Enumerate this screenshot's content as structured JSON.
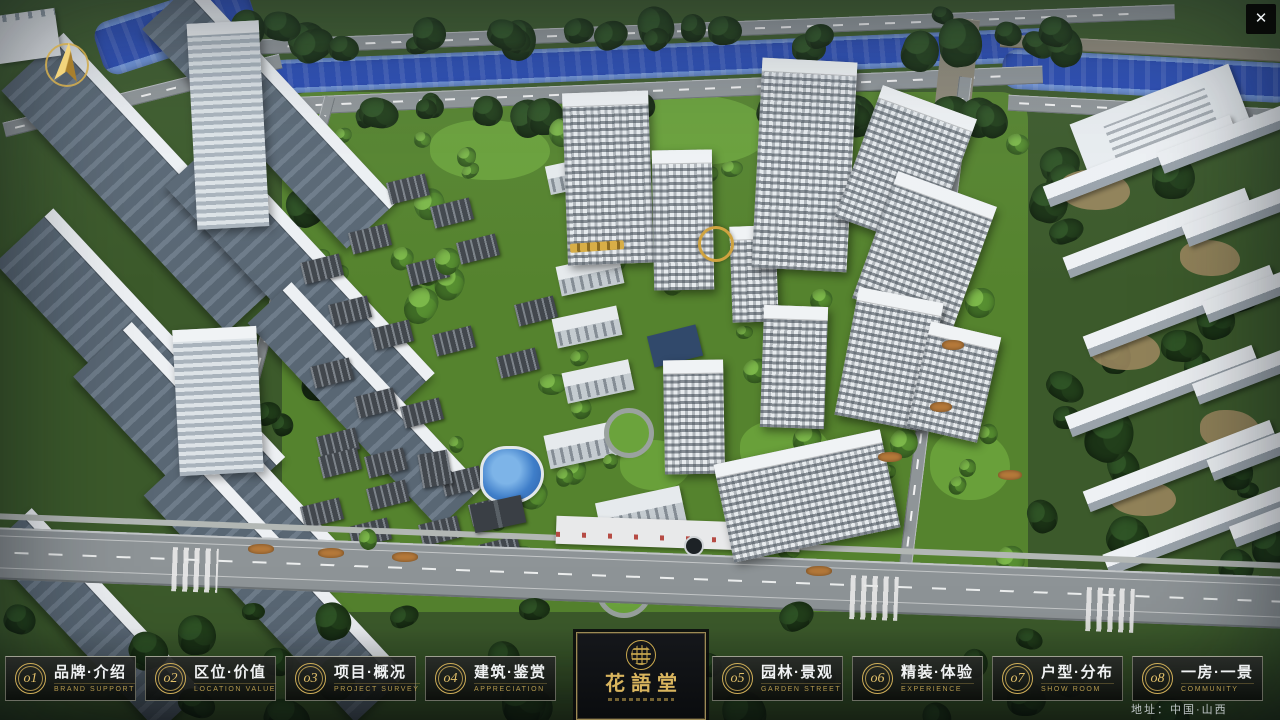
{
  "nav": {
    "items": [
      {
        "num": "o1",
        "label": "品牌·介绍",
        "sub": "BRAND SUPPORT"
      },
      {
        "num": "o2",
        "label": "区位·价值",
        "sub": "LOCATION VALUE"
      },
      {
        "num": "o3",
        "label": "项目·概况",
        "sub": "PROJECT SURVEY"
      },
      {
        "num": "o4",
        "label": "建筑·鉴赏",
        "sub": "APPRECIATION"
      },
      {
        "num": "o5",
        "label": "园林·景观",
        "sub": "GARDEN STREET"
      },
      {
        "num": "o6",
        "label": "精装·体验",
        "sub": "EXPERIENCE"
      },
      {
        "num": "o7",
        "label": "户型·分布",
        "sub": "SHOW ROOM"
      },
      {
        "num": "o8",
        "label": "一房·一景",
        "sub": "COMMUNITY"
      }
    ]
  },
  "logo": {
    "title": "花語堂"
  },
  "overlay": {
    "close_label": "✕",
    "address": "地址：中国·山西"
  },
  "colors": {
    "gold": "#c9a84e",
    "panel_bg": "#101210",
    "river_blue": "#2a4cb4",
    "community_green": "#55832e"
  }
}
